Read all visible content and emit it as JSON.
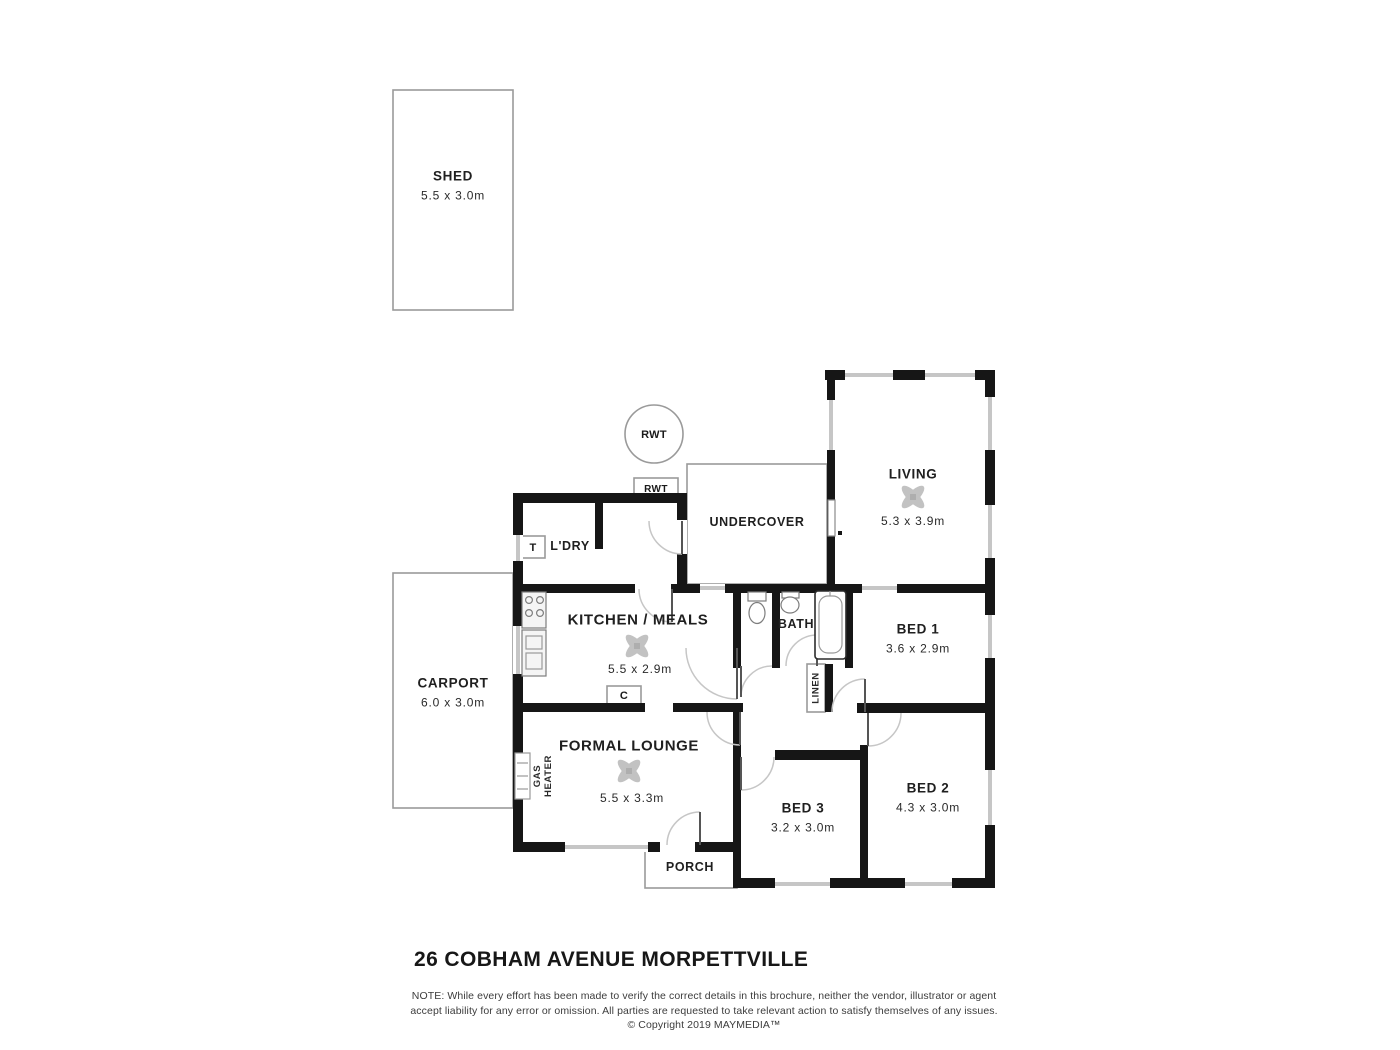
{
  "title": "26 COBHAM AVENUE MORPETTVILLE",
  "disclaimer": {
    "line1": "NOTE: While every effort has been made to verify the correct details in this brochure, neither the vendor, illustrator or agent",
    "line2": "accept liability for any error or omission. All parties are requested to take relevant action to satisfy themselves of any issues.",
    "line3": "© Copyright 2019 MAYMEDIA™"
  },
  "rooms": {
    "shed": {
      "name": "SHED",
      "dims": "5.5 x 3.0m"
    },
    "carport": {
      "name": "CARPORT",
      "dims": "6.0 x 3.0m"
    },
    "living": {
      "name": "LIVING",
      "dims": "5.3 x 3.9m"
    },
    "undercover": {
      "name": "UNDERCOVER"
    },
    "laundry": {
      "name": "L'DRY"
    },
    "kitchen": {
      "name": "KITCHEN / MEALS",
      "dims": "5.5 x 2.9m"
    },
    "lounge": {
      "name": "FORMAL LOUNGE",
      "dims": "5.5 x 3.3m"
    },
    "bath": {
      "name": "BATH"
    },
    "bed1": {
      "name": "BED 1",
      "dims": "3.6 x 2.9m"
    },
    "bed2": {
      "name": "BED 2",
      "dims": "4.3 x 3.0m"
    },
    "bed3": {
      "name": "BED 3",
      "dims": "3.2 x 3.0m"
    },
    "porch": {
      "name": "PORCH"
    }
  },
  "markers": {
    "rwt_tank": "RWT",
    "rwt_box": "RWT",
    "trough": "T",
    "cupboard": "C",
    "linen": "LINEN",
    "gas_line1": "GAS",
    "gas_line2": "HEATER"
  },
  "colors": {
    "wall": "#161616",
    "thin_outline": "#9a9a9a",
    "window": "#c6c6c6",
    "door_arc": "#c6c6c6",
    "fan": "#c2c2c2"
  }
}
